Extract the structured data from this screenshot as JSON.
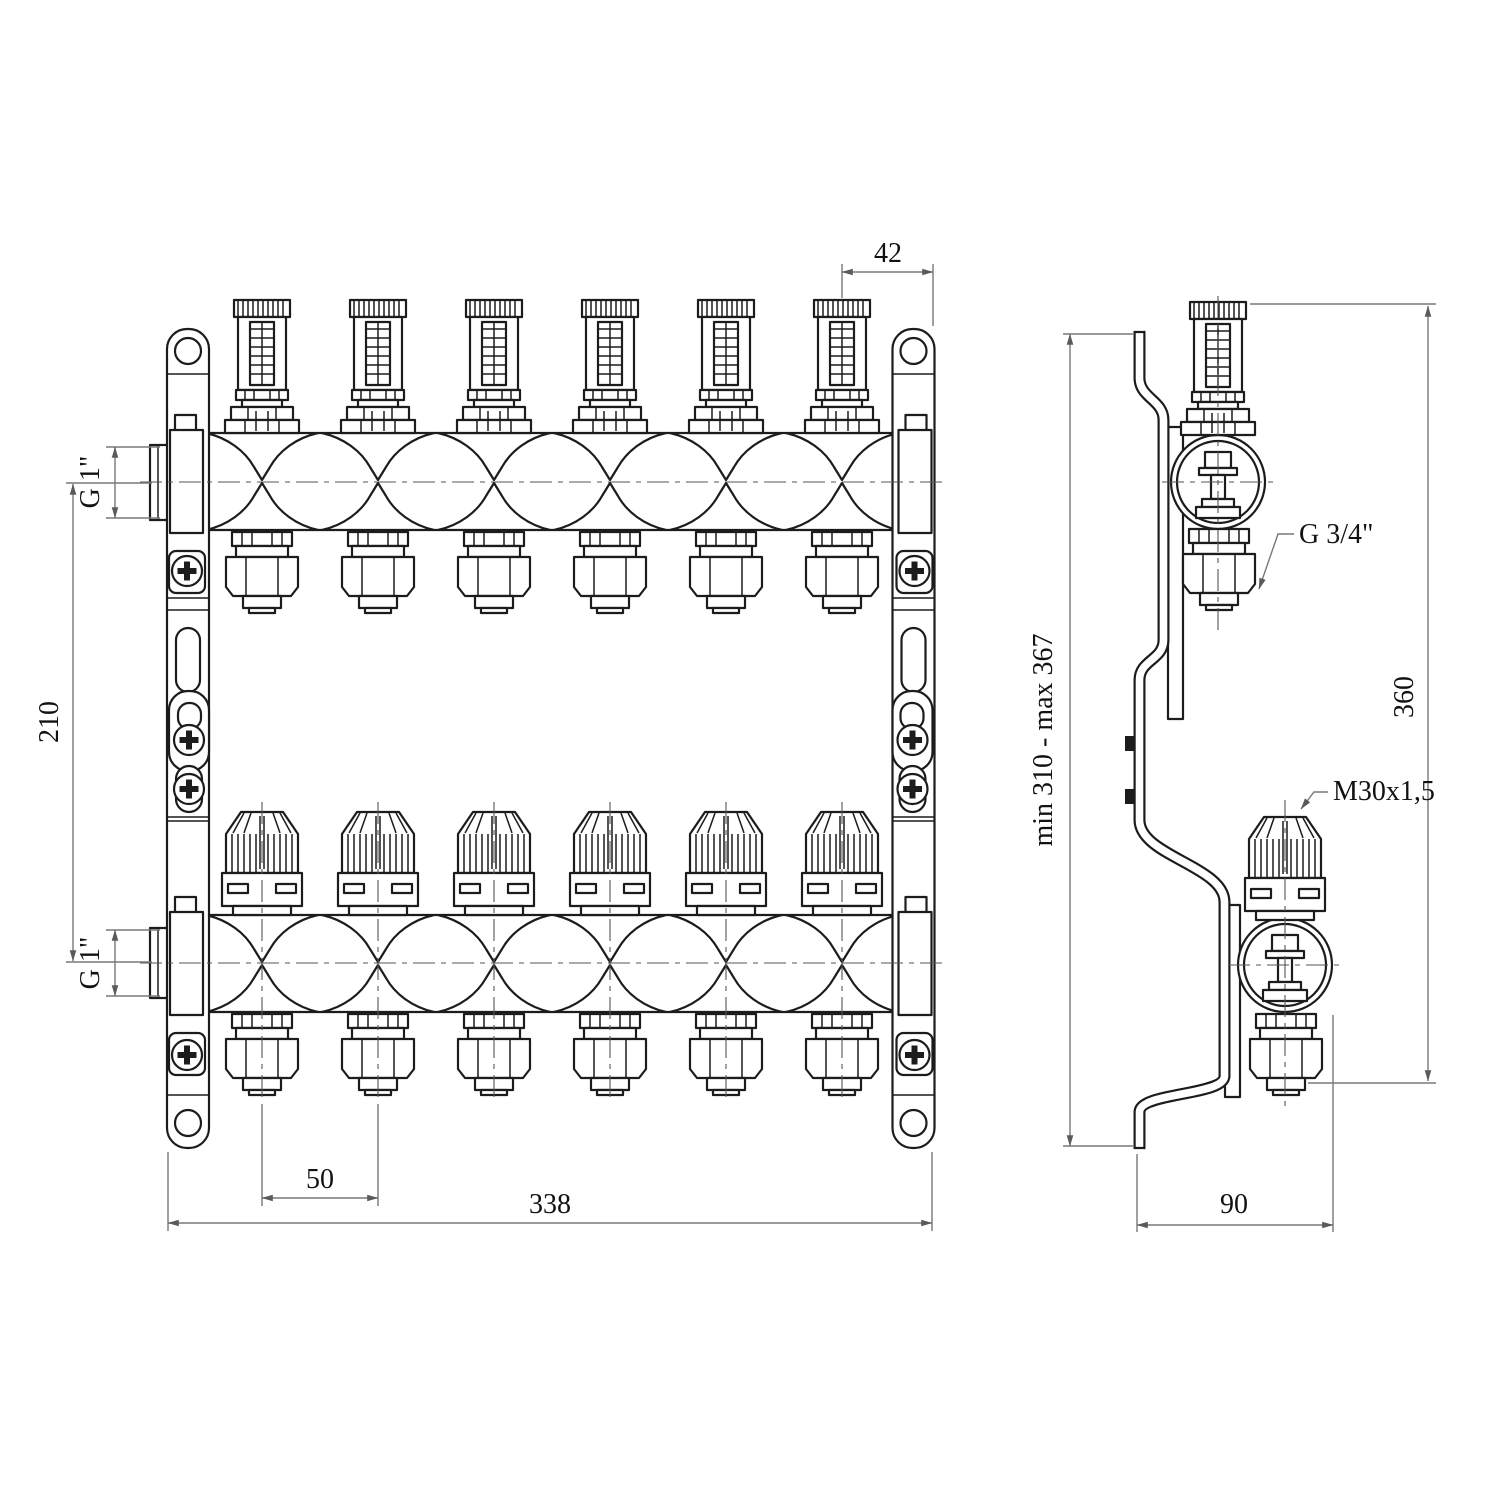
{
  "drawing": {
    "subject": "heating manifold with flow meters, front and side orthographic views",
    "outlet_count": 6,
    "colors": {
      "object_line": "#1c1c1c",
      "dimension_line": "#787878",
      "background": "#ffffff",
      "text": "#121212"
    },
    "front_view": {
      "dims": {
        "end_offset": "42",
        "supply_thread": "G 1\"",
        "row_spacing": "210",
        "return_thread": "G 1\"",
        "outlet_spacing": "50",
        "total_width": "338"
      }
    },
    "side_view": {
      "dims": {
        "mount_height_range": "min 310 - max 367",
        "total_height": "360",
        "depth": "90"
      },
      "labels": {
        "outlet_connection": "G 3/4\"",
        "valve_thread": "M30x1,5"
      }
    }
  }
}
